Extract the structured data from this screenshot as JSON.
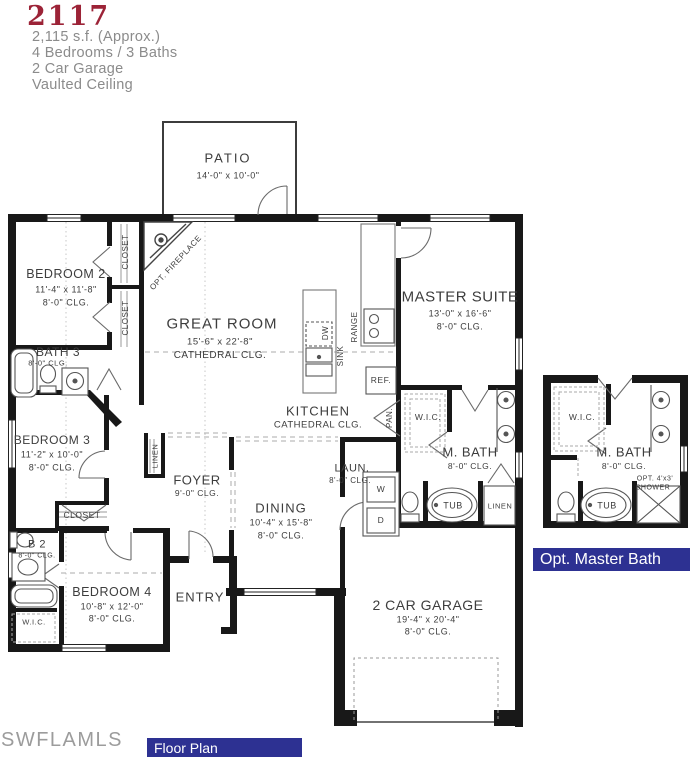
{
  "header": {
    "plan_number": "2117",
    "area": "2,115 s.f. (Approx.)",
    "beds_baths": "4 Bedrooms / 3 Baths",
    "garage": "2 Car Garage",
    "ceiling": "Vaulted Ceiling"
  },
  "rooms": {
    "patio": {
      "name": "PATIO",
      "dims": "14'-0\" x 10'-0\""
    },
    "bedroom2": {
      "name": "BEDROOM 2",
      "dims": "11'-4\" x 11'-8\"",
      "clg": "8'-0\" CLG."
    },
    "great_room": {
      "name": "GREAT ROOM",
      "dims": "15'-6\" x 22'-8\"",
      "clg": "CATHEDRAL CLG."
    },
    "master_suite": {
      "name": "MASTER SUITE",
      "dims": "13'-0\" x 16'-6\"",
      "clg": "8'-0\" CLG."
    },
    "bath3": {
      "name": "BATH 3",
      "clg": "8'-0\" CLG."
    },
    "bedroom3": {
      "name": "BEDROOM 3",
      "dims": "11'-2\" x 10'-0\"",
      "clg": "8'-0\" CLG."
    },
    "kitchen": {
      "name": "KITCHEN",
      "clg": "CATHEDRAL CLG."
    },
    "foyer": {
      "name": "FOYER",
      "clg": "9'-0\" CLG."
    },
    "dining": {
      "name": "DINING",
      "dims": "10'-4\" x 15'-8\"",
      "clg": "8'-0\" CLG."
    },
    "laundry": {
      "name": "LAUN.",
      "clg": "8'-0\" CLG.",
      "washer": "W",
      "dryer": "D"
    },
    "bath2": {
      "name": "B 2",
      "clg": "8'-0\" CLG."
    },
    "bedroom4": {
      "name": "BEDROOM 4",
      "dims": "10'-8\" x 12'-0\"",
      "clg": "8'-0\" CLG."
    },
    "entry": {
      "name": "ENTRY"
    },
    "garage": {
      "name": "2 CAR GARAGE",
      "dims": "19'-4\" x 20'-4\"",
      "clg": "8'-0\" CLG."
    },
    "master_bath": {
      "name": "M. BATH",
      "clg": "8'-0\" CLG.",
      "tub": "TUB",
      "linen": "LINEN",
      "wic": "W.I.C."
    }
  },
  "fixtures": {
    "closet": "CLOSET",
    "closet_bed3": "CLOSET",
    "linen_hall": "LINEN",
    "opt_fireplace": "OPT. FIREPLACE",
    "dw": "DW",
    "sink": "SINK",
    "range": "RANGE",
    "ref": "REF.",
    "pantry": "PAN.",
    "wic_bed4": "W.I.C."
  },
  "opt_master_bath": {
    "wic": "W.I.C.",
    "name": "M. BATH",
    "clg": "8'-0\" CLG.",
    "tub": "TUB",
    "shower_line1": "OPT. 4'x3'",
    "shower_line2": "SHOWER",
    "banner": "Opt. Master Bath"
  },
  "footer": {
    "watermark": "SWFLAMLS",
    "caption": "Floor Plan"
  },
  "colors": {
    "plan_number": "#9c2337",
    "banner_bg": "#2d3192",
    "banner_text": "#ffffff",
    "wall": "#181818",
    "label": "#3d3d3d",
    "muted": "#8b8b8b"
  }
}
